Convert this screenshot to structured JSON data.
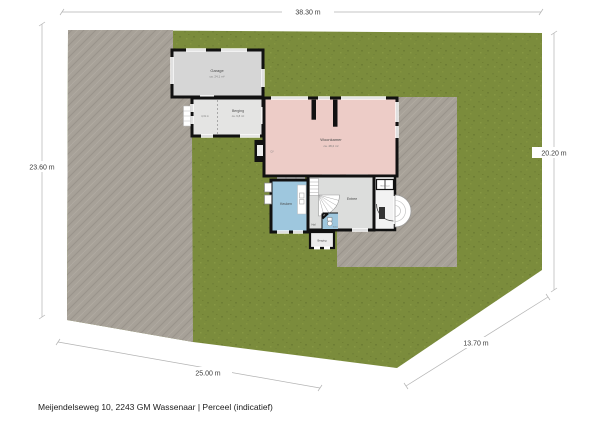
{
  "caption": "Meijendelseweg 10, 2243 GM Wassenaar | Perceel (indicatief)",
  "dimensions": {
    "top": "38.30 m",
    "left": "23.60 m",
    "right": "20.20 m",
    "bottom": "25.00 m",
    "diagonal": "13.70 m"
  },
  "rooms": {
    "garage": {
      "label": "Garage",
      "area": "ca. 24,1 m²"
    },
    "berging": {
      "label": "Berging",
      "area": "ca. 9,8 m²"
    },
    "berging_annex": {
      "label": "4,31 m"
    },
    "woonkamer": {
      "label": "Woonkamer",
      "area": "ca. 48,2 m²"
    },
    "keuken": {
      "label": "Keuken"
    },
    "entree": {
      "label": "Entree"
    },
    "hal": {
      "label": "Hal"
    },
    "toilet": {
      "label": "Toilet"
    },
    "achterberging": {
      "label": "Berging"
    },
    "meterkast": {
      "label": "Meterkast"
    },
    "cv": {
      "label": "CV"
    }
  },
  "colors": {
    "lawn": "#7b8c3c",
    "pavement": "#a7a198",
    "wall": "#111111",
    "living": "#edccc7",
    "kitchen": "#9ec7de",
    "entry": "#dcdddc",
    "garage": "#d6d6d6",
    "storage": "#e4e4e3"
  }
}
